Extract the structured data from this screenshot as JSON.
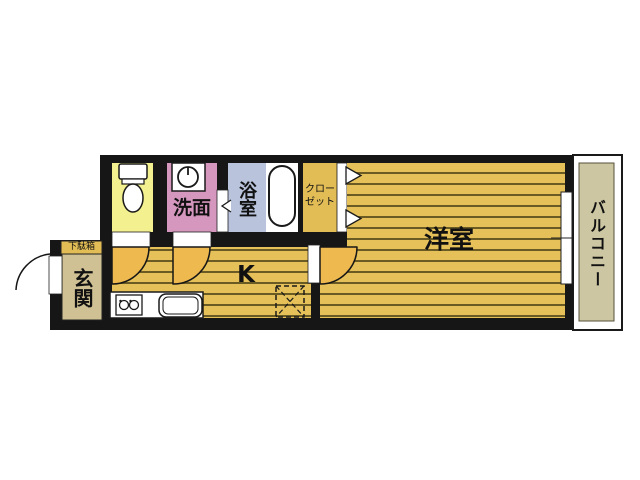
{
  "floorplan": {
    "labels": {
      "shoe_cabinet": "下駄箱",
      "entrance": "玄関",
      "washroom": "洗面",
      "bathroom": "浴室",
      "closet": "クローゼット",
      "kitchen": "K",
      "western_room": "洋室",
      "balcony": "バルコニー"
    },
    "icons": {
      "toilet": "toilet-icon",
      "washing_machine": "washing-machine-icon",
      "bathtub": "bathtub-icon",
      "stove": "stove-icon",
      "sink": "sink-icon",
      "refrigerator_space": "refrigerator-dashed-box",
      "door_swings": "door-swing-arc",
      "folding_door": "chevron-folding-door",
      "sliding_window": "sliding-window-bar"
    },
    "colors": {
      "wall": "#161616",
      "floor_yellow": "#e6c159",
      "floor_line": "#6a5b25",
      "door_fan": "#eeba4f",
      "toilet_yellow": "#f3f08f",
      "washroom_pink": "#d697be",
      "bathroom_blue": "#b9c3db",
      "closet_gold": "#e2bc55",
      "entrance_tan": "#cfc193",
      "balcony_tan": "#cdc6a2",
      "background": "#ffffff"
    }
  }
}
